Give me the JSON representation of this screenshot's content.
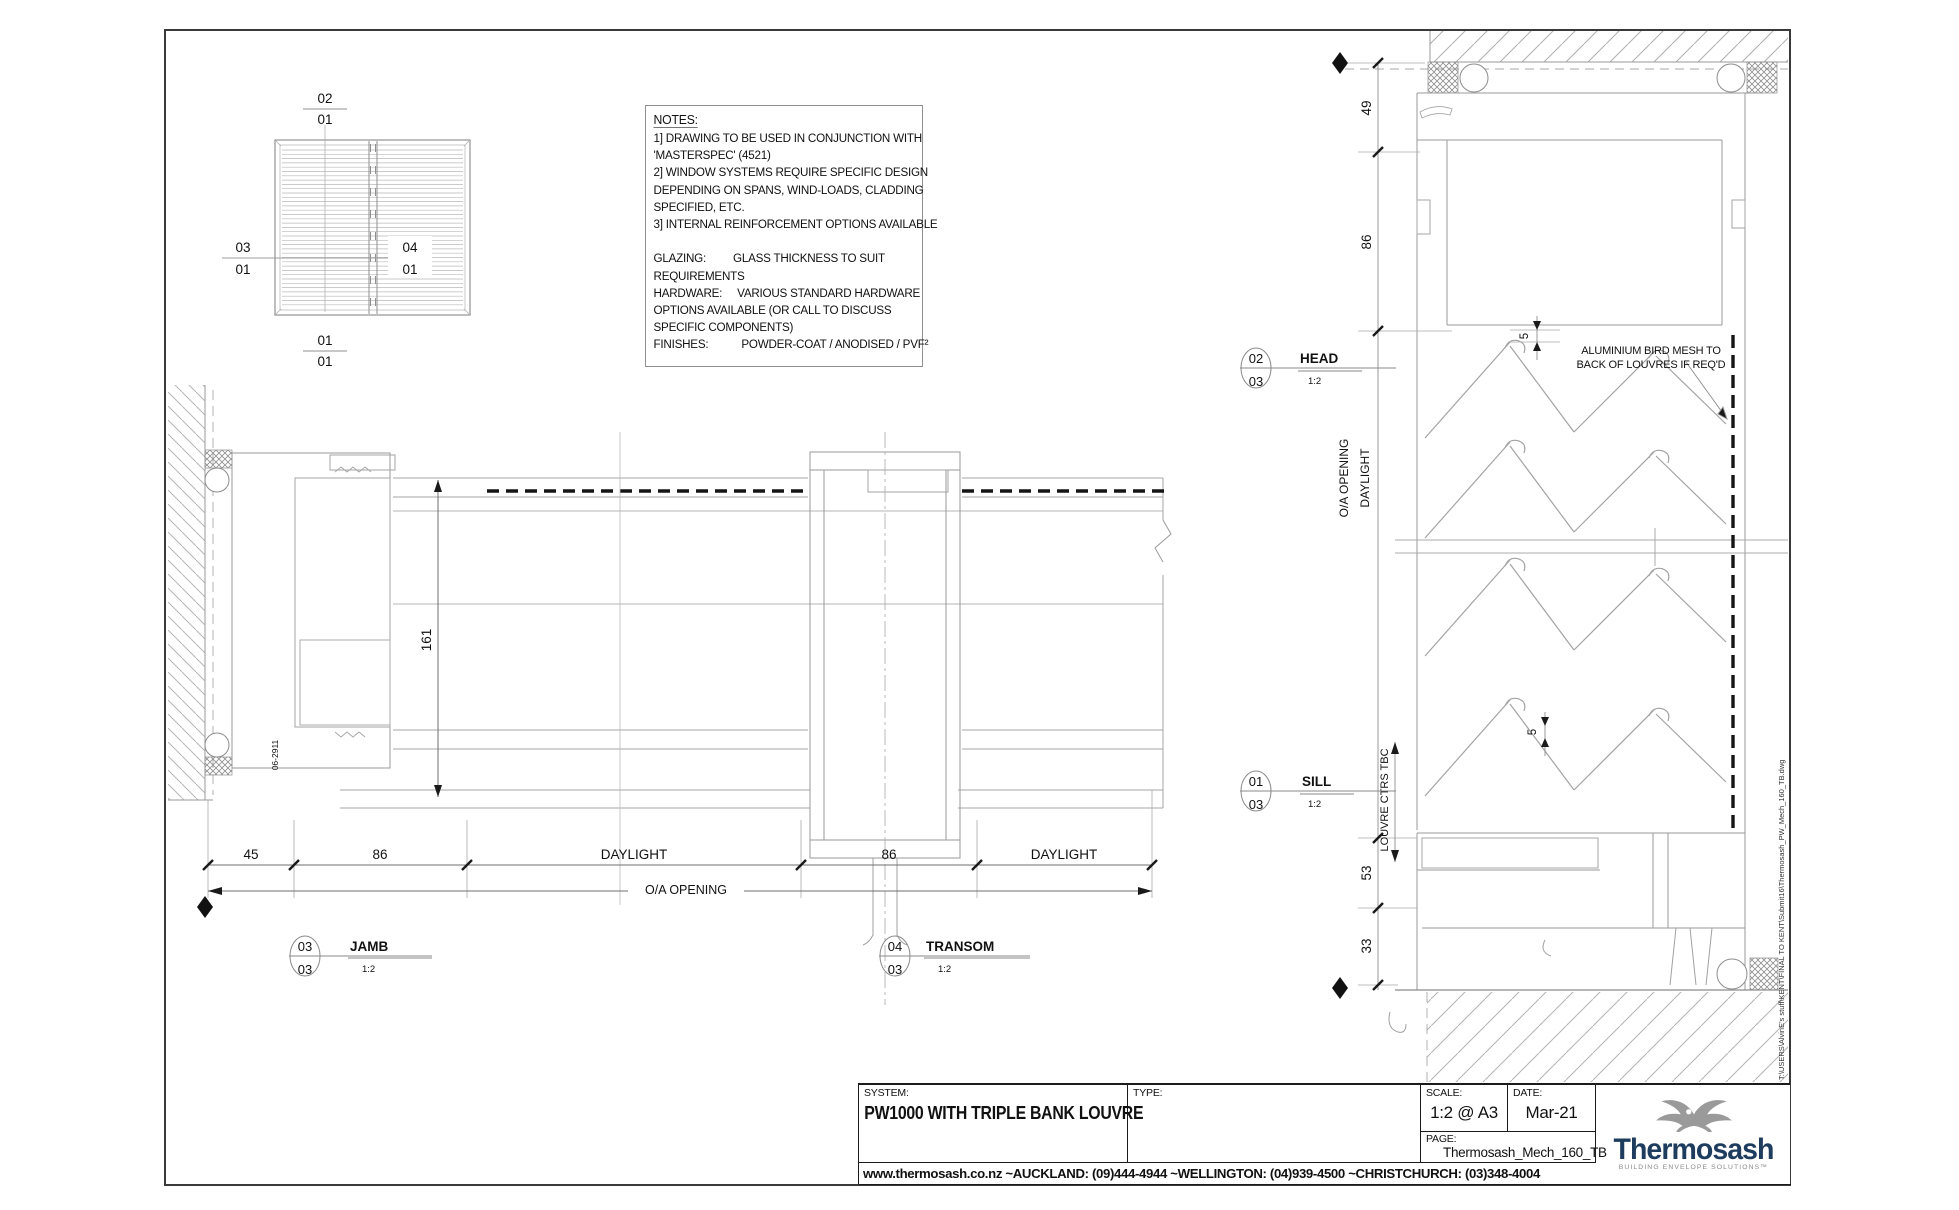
{
  "notes": {
    "title": "NOTES:",
    "lines": [
      "1] DRAWING TO BE USED IN CONJUNCTION WITH",
      "'MASTERSPEC' (4521)",
      "2] WINDOW SYSTEMS REQUIRE SPECIFIC DESIGN",
      "DEPENDING ON SPANS, WIND-LOADS, CLADDING",
      "SPECIFIED, ETC.",
      "3] INTERNAL REINFORCEMENT OPTIONS AVAILABLE",
      "",
      "GLAZING:         GLASS THICKNESS TO SUIT",
      "REQUIREMENTS",
      "HARDWARE:     VARIOUS STANDARD HARDWARE",
      "OPTIONS AVAILABLE (OR CALL TO DISCUSS",
      "SPECIFIC COMPONENTS)",
      "FINISHES:           POWDER-COAT / ANODISED / PVF²"
    ]
  },
  "elevation": {
    "callout_top": {
      "top": "02",
      "bottom": "01"
    },
    "callout_left": {
      "top": "03",
      "bottom": "01"
    },
    "callout_right": {
      "top": "04",
      "bottom": "01"
    },
    "callout_bottom": {
      "top": "01",
      "bottom": "01"
    }
  },
  "plan": {
    "dim_45": "45",
    "dim_86a": "86",
    "dim_daylight_a": "DAYLIGHT",
    "dim_86b": "86",
    "dim_daylight_b": "DAYLIGHT",
    "dim_overall": "O/A OPENING",
    "dim_161": "161",
    "part_label": "06-2911",
    "jamb_callout": {
      "num": "03",
      "sheet": "03",
      "title": "JAMB",
      "scale": "1:2"
    },
    "transom_callout": {
      "num": "04",
      "sheet": "03",
      "title": "TRANSOM",
      "scale": "1:2"
    }
  },
  "section": {
    "dim_49": "49",
    "dim_86": "86",
    "dim_5a": "5",
    "dim_5b": "5",
    "dim_53": "53",
    "dim_33": "33",
    "oa_opening": "O/A OPENING",
    "daylight": "DAYLIGHT",
    "louvre_ctrs": "LOUVRE CTRS TBC",
    "bird_mesh_note": "ALUMINIUM BIRD MESH TO\nBACK OF LOUVRES IF REQ'D",
    "head_callout": {
      "num": "02",
      "sheet": "03",
      "title": "HEAD",
      "scale": "1:2"
    },
    "sill_callout": {
      "num": "01",
      "sheet": "03",
      "title": "SILL",
      "scale": "1:2"
    }
  },
  "file_path": "T:\\USERS\\AlvinE's stuff\\KENT\\FINAL TO KENT\\Submit16\\Thermosash_PW_Mech_160_TB.dwg",
  "title_block": {
    "system_label": "SYSTEM:",
    "system_value": "PW1000 WITH TRIPLE BANK LOUVRE",
    "type_label": "TYPE:",
    "type_value": ".",
    "scale_label": "SCALE:",
    "scale_value": "1:2 @ A3",
    "date_label": "DATE:",
    "date_value": "Mar-21",
    "page_label": "PAGE:",
    "page_value": "Thermosash_Mech_160_TB",
    "logo_text": "Thermosash",
    "logo_tagline": "BUILDING ENVELOPE SOLUTIONS™",
    "footer": "www.thermosash.co.nz ~AUCKLAND: (09)444-4944 ~WELLINGTON: (04)939-4500 ~CHRISTCHURCH: (03)348-4004"
  },
  "colors": {
    "logo_navy": "#1d3c5e",
    "logo_gray": "#9a9a9a",
    "line_gray": "#9a9a9a",
    "dim_black": "#1a1a1a"
  }
}
